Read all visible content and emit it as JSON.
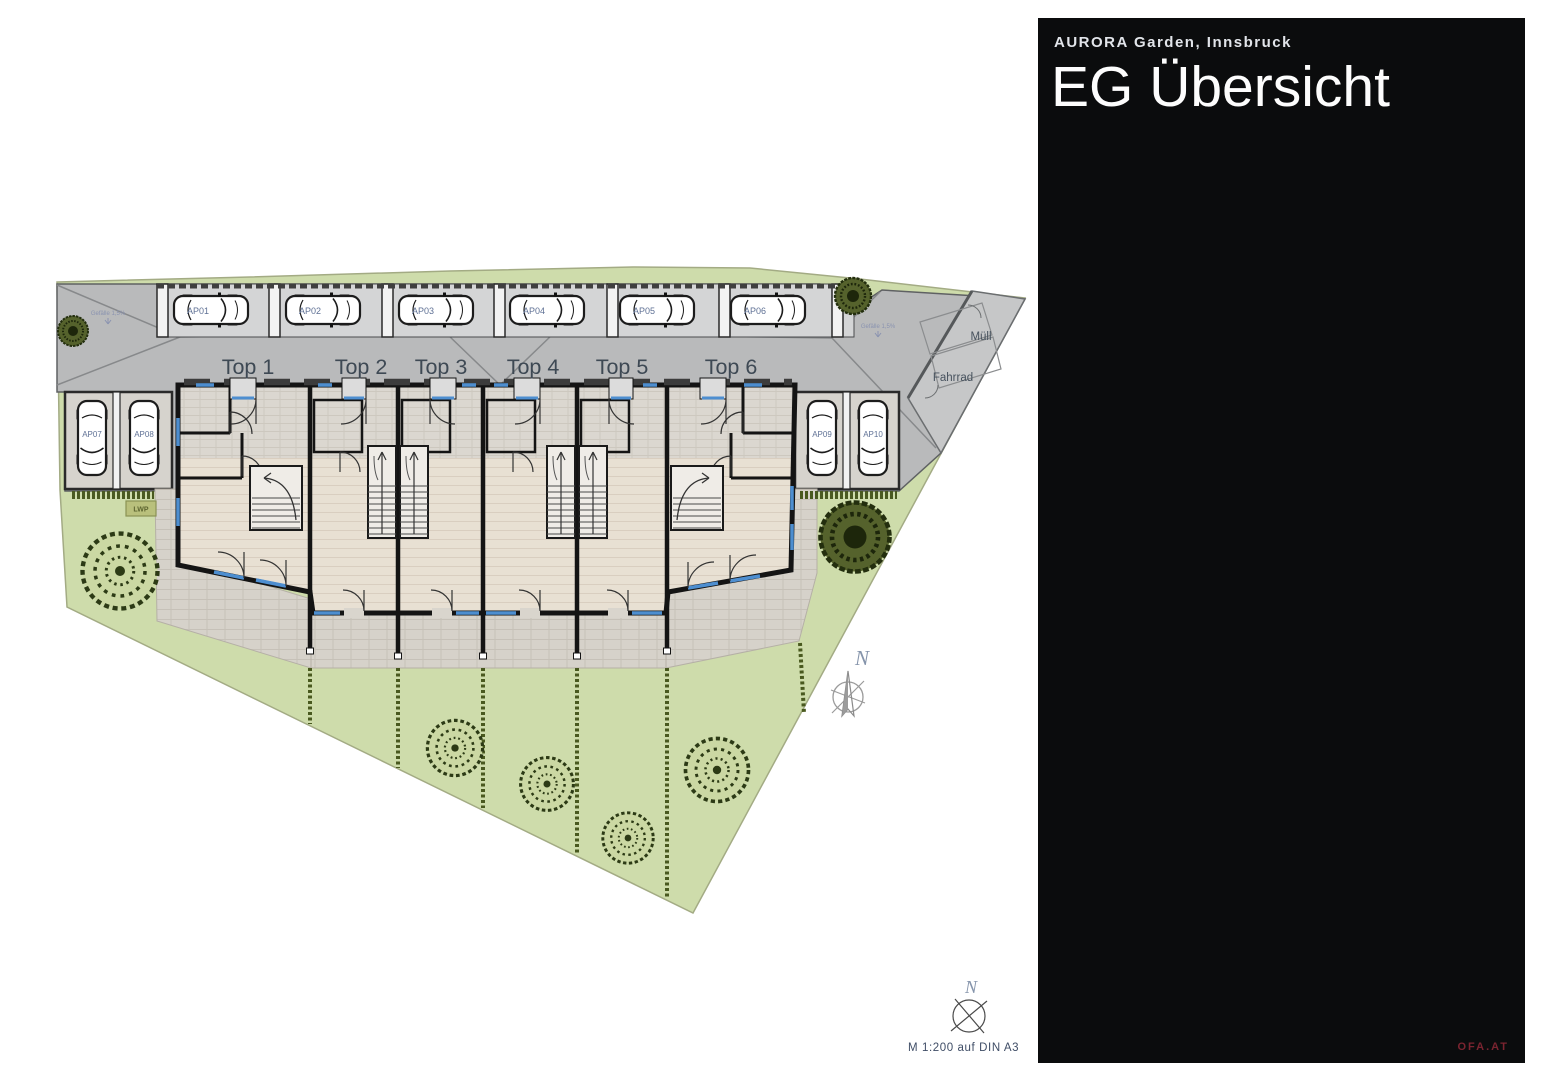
{
  "panel": {
    "project_label": "AURORA Garden, Innsbruck",
    "page_title": "EG Übersicht",
    "brand": "OFA.AT"
  },
  "plan": {
    "units": [
      {
        "label": "Top 1"
      },
      {
        "label": "Top 2"
      },
      {
        "label": "Top 3"
      },
      {
        "label": "Top 4"
      },
      {
        "label": "Top 5"
      },
      {
        "label": "Top 6"
      }
    ],
    "parking": {
      "top": [
        "AP01",
        "AP02",
        "AP03",
        "AP04",
        "AP05",
        "AP06"
      ],
      "left": [
        "AP07",
        "AP08"
      ],
      "right": [
        "AP09",
        "AP10"
      ]
    },
    "rooms": {
      "waste": "Müll",
      "bikes": "Fahrrad",
      "heat_pump": "LWP"
    },
    "notes": {
      "slope": "Gefälle 1,5%",
      "north": "N",
      "scale": "M 1:200 auf DIN A3"
    }
  }
}
